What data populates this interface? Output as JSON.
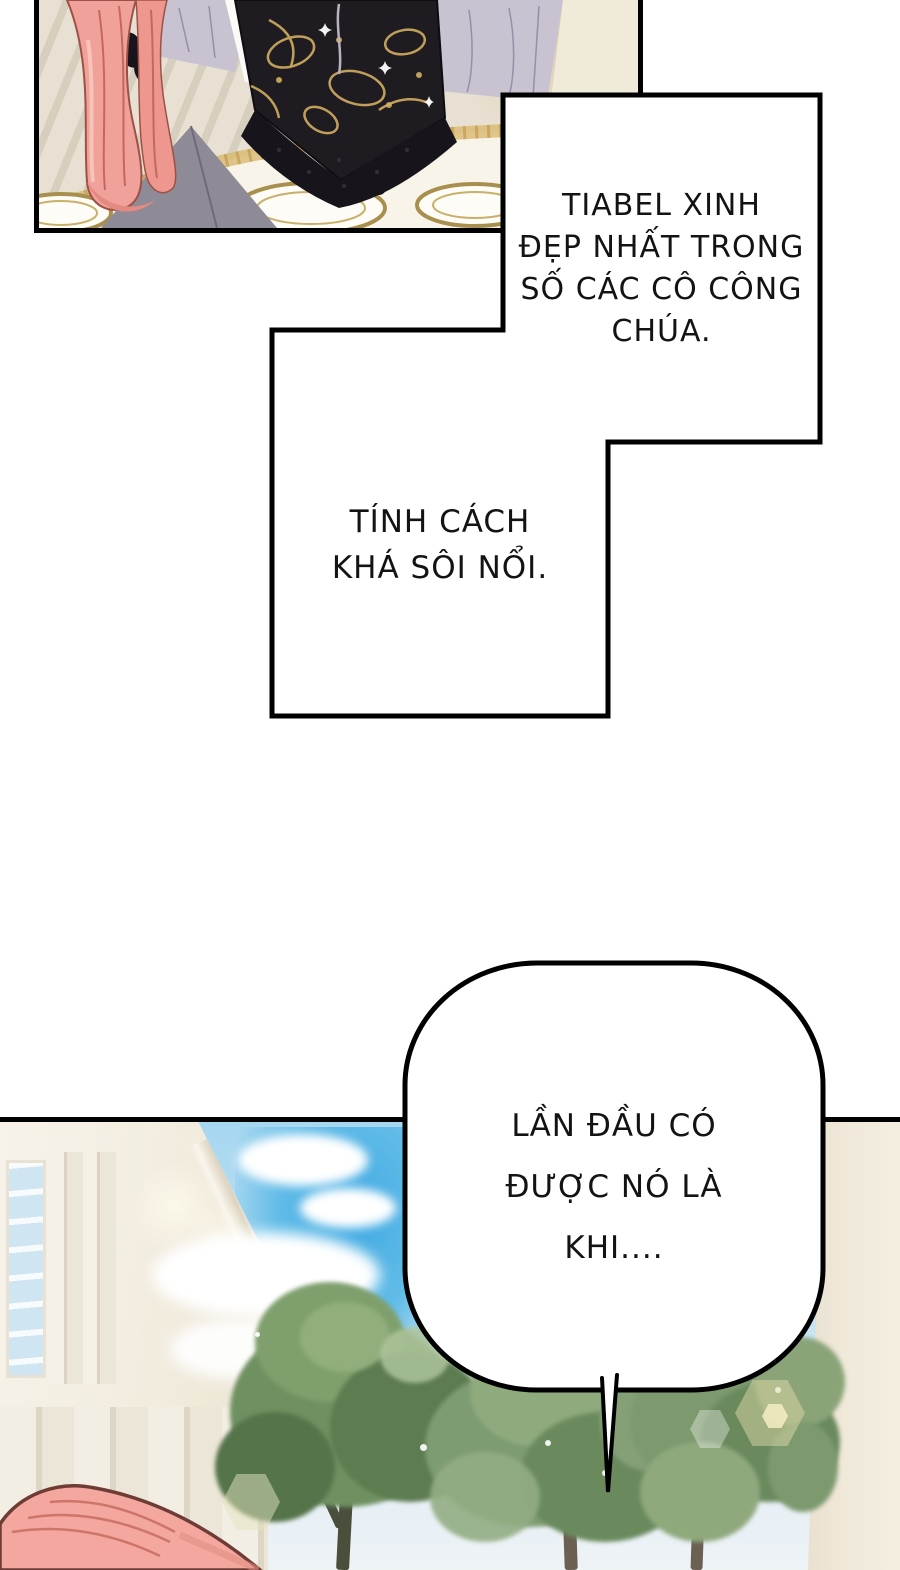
{
  "page": {
    "type": "comic-page",
    "width": 900,
    "height": 1570,
    "background": "#ffffff",
    "ink": "#000000"
  },
  "speech_boxes": {
    "top_right": {
      "shape": "stepped-rectangle",
      "lines": [
        "TIABEL XINH",
        "ĐẸP NHẤT TRONG",
        "SỐ CÁC CÔ CÔNG",
        "CHÚA."
      ]
    },
    "middle_left": {
      "shape": "stepped-rectangle",
      "lines": [
        "TÍNH CÁCH",
        "KHÁ SÔI NỔI."
      ]
    },
    "bottom": {
      "shape": "rounded-bubble-with-tail",
      "lines": [
        "LẦN ĐẦU CÓ",
        "ĐƯỢC NÓ LÀ",
        "KHI...."
      ]
    }
  },
  "panels": {
    "dinner_scene": {
      "palette": {
        "background": "#e8e1d3",
        "hair_pink": "#f0a29a",
        "gown_black": "#1e1b21",
        "gold_pattern": "#d2ae62",
        "lavender_fabric": "#c8c2d1",
        "tablecloth": "#f8f4ea",
        "plate_gold": "#a98f4e",
        "skirt_gray": "#8e8a96",
        "candle": "#f7f2e7"
      }
    },
    "garden_scene": {
      "palette": {
        "sky_vivid": "#3fa9e2",
        "sky_light": "#c2e2f3",
        "cloud": "#ffffff",
        "building": "#f4efe4",
        "window_glass": "#cfe6f2",
        "pillar": "#efe8da",
        "foliage_dark": "#5d7c50",
        "foliage_mid": "#7e9c72",
        "foliage_light": "#9db98a",
        "trunk": "#6b6052",
        "hair_pink": "#f3a79e",
        "bokeh": "#e2dbaa"
      }
    }
  }
}
